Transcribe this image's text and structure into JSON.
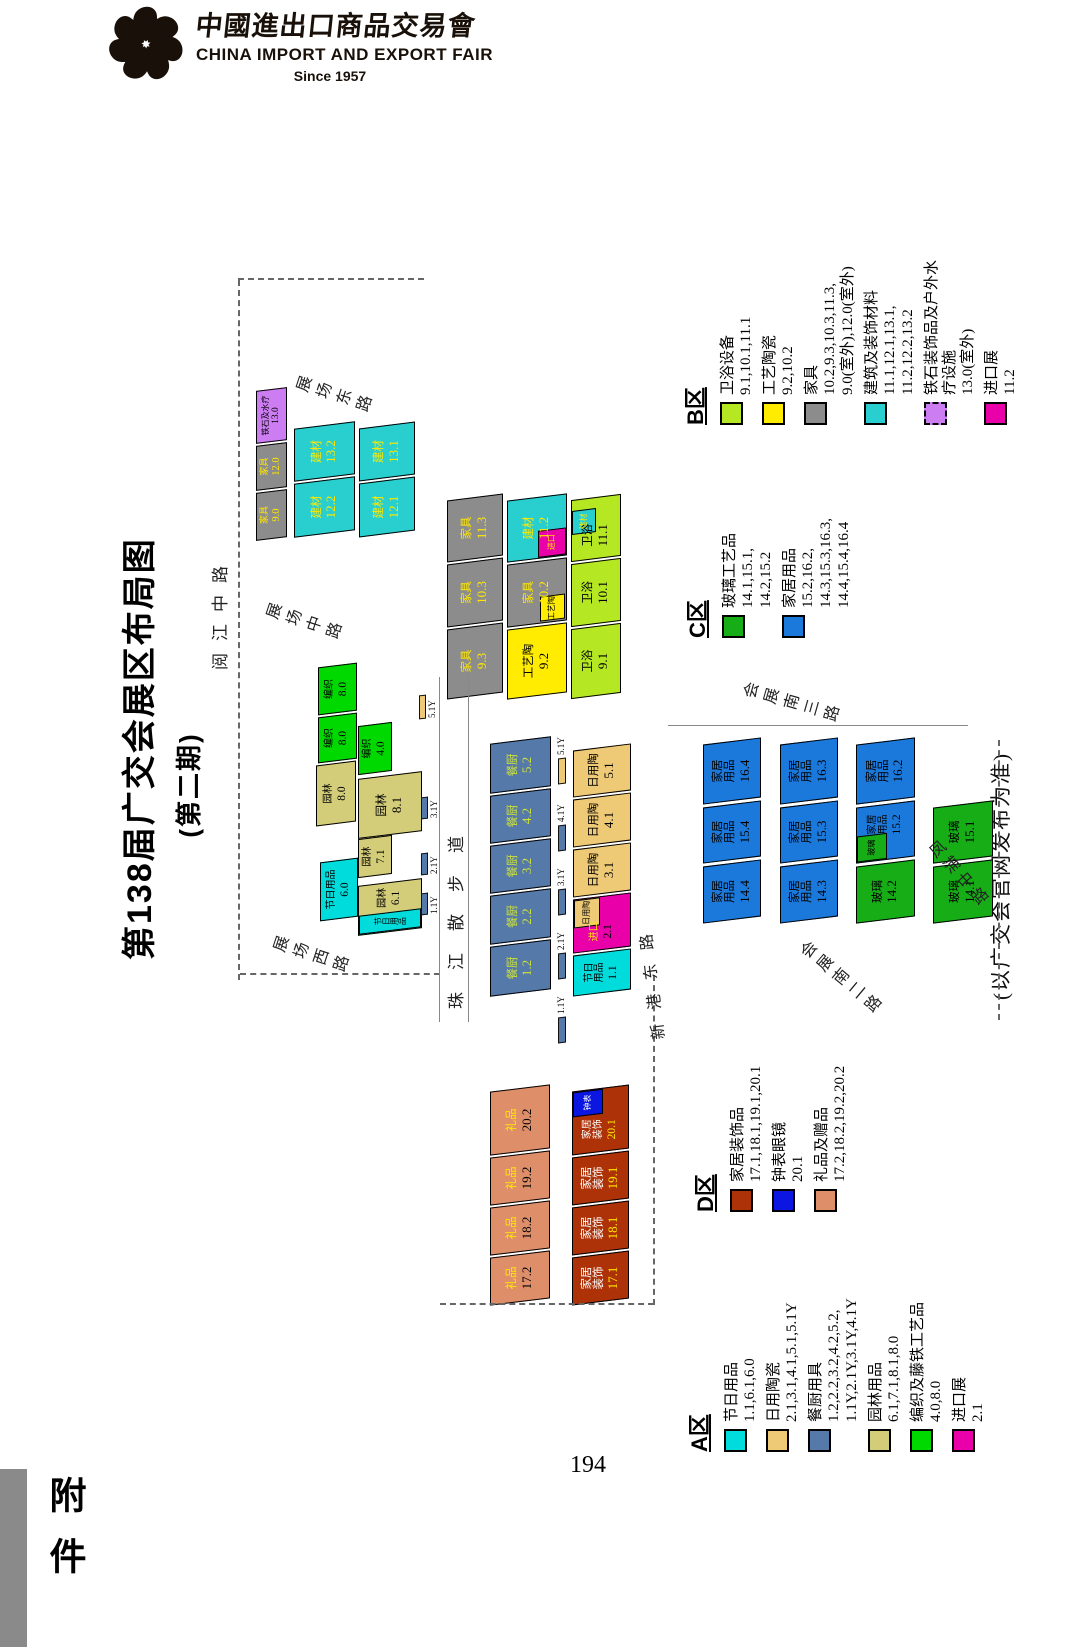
{
  "header": {
    "logo_cn": "中國進出口商品交易會",
    "logo_en": "CHINA IMPORT AND EXPORT FAIR",
    "logo_since": "Since 1957"
  },
  "title": {
    "main": "第138届广交会展区布局图",
    "sub": "(第二期)"
  },
  "note": "(以广交会官网发布为准)",
  "footer": {
    "page_number": "194",
    "attachment": "附件"
  },
  "icons": {
    "logo": "canton-fair-flower-icon"
  },
  "colors": {
    "cyan": "#00dbdb",
    "wheat": "#efca76",
    "steelblue": "#5579a8",
    "khaki": "#d3cc79",
    "agreen": "#00d900",
    "magenta": "#ea00a8",
    "ygreen": "#b5e822",
    "yellow": "#ffec00",
    "gray": "#8c8c8c",
    "teal": "#29cfcf",
    "violet": "#cd7df2",
    "darkred": "#ae3208",
    "salmon": "#df8e6a",
    "cblue": "#1c79dc",
    "cgreen": "#16ad16",
    "dblue": "#0b16e0"
  },
  "legends": [
    {
      "id": "A",
      "title": "A区",
      "x": 8,
      "y": 592,
      "w": 215,
      "entries": [
        {
          "name": "节日用品",
          "nums": [
            "1.1,6.1,6.0"
          ],
          "color": "cyan"
        },
        {
          "name": "日用陶瓷",
          "nums": [
            "2.1,3.1,4.1,5.1,5.1Y"
          ],
          "color": "wheat"
        },
        {
          "name": "餐厨用具",
          "nums": [
            "1.2,2.2,3.2,4.2,5.2,",
            "1.1Y,2.1Y,3.1Y,4.1Y"
          ],
          "color": "steelblue"
        },
        {
          "name": "园林用品",
          "nums": [
            "6.1,7.1,8.1,8.0"
          ],
          "color": "khaki"
        },
        {
          "name": "编织及藤铁工艺品",
          "nums": [
            "4.0,8.0"
          ],
          "color": "agreen"
        },
        {
          "name": "进口展",
          "nums": [
            "2.1"
          ],
          "color": "magenta"
        }
      ]
    },
    {
      "id": "D",
      "title": "D区",
      "x": 248,
      "y": 598,
      "w": 220,
      "entries": [
        {
          "name": "家居装饰品",
          "nums": [
            "17.1,18.1,19.1,20.1"
          ],
          "color": "darkred"
        },
        {
          "name": "钟表眼镜",
          "nums": [
            "20.1"
          ],
          "color": "dblue"
        },
        {
          "name": "礼品及赠品",
          "nums": [
            "17.2,18.2,19.2,20.2"
          ],
          "color": "salmon"
        }
      ]
    },
    {
      "id": "C",
      "title": "C区",
      "x": 822,
      "y": 590,
      "w": 205,
      "entries": [
        {
          "name": "玻璃工艺品",
          "nums": [
            "14.1,15.1,",
            "14.2,15.2"
          ],
          "color": "cgreen"
        },
        {
          "name": "家居用品",
          "nums": [
            "15.2,16.2,",
            "14.3,15.3,16.3,",
            "14.4,15.4,16.4"
          ],
          "color": "cblue"
        }
      ]
    },
    {
      "id": "B",
      "title": "B区",
      "x": 1035,
      "y": 588,
      "w": 175,
      "entries": [
        {
          "name": "卫浴设备",
          "nums": [
            "9.1,10.1,11.1"
          ],
          "color": "ygreen"
        },
        {
          "name": "工艺陶瓷",
          "nums": [
            "9.2,10.2"
          ],
          "color": "yellow"
        },
        {
          "name": "家具",
          "nums": [
            "10.2,9.3,10.3,11.3,",
            "9.0(室外),12.0(室外)"
          ],
          "color": "gray"
        },
        {
          "name": "建筑及装饰材料",
          "nums": [
            "11.1,12.1,13.1,",
            "11.2,12.2,13.2"
          ],
          "color": "teal"
        },
        {
          "name": "铁石装饰品及户外水疗设施",
          "nums": [
            "13.0(室外)"
          ],
          "color": "violet",
          "dashed": true
        },
        {
          "name": "进口展",
          "nums": [
            "11.2"
          ],
          "color": "magenta"
        }
      ]
    }
  ],
  "map": {
    "blocks": [
      {
        "n": "家具",
        "v": "9.0",
        "c": "gray",
        "x": 921,
        "y": 166,
        "w": 48,
        "h": 31,
        "fs": 9
      },
      {
        "n": "家具",
        "v": "12.0",
        "c": "gray",
        "x": 971,
        "y": 166,
        "w": 45,
        "h": 31,
        "fs": 9
      },
      {
        "n": "铁石及水疗",
        "v": "13.0",
        "c": "violet",
        "x": 1018,
        "y": 166,
        "w": 53,
        "h": 31,
        "fs": 8
      },
      {
        "n": "建材",
        "v": "12.2",
        "c": "teal",
        "x": 926,
        "y": 204,
        "w": 54,
        "h": 61
      },
      {
        "n": "建材",
        "v": "13.2",
        "c": "teal",
        "x": 982,
        "y": 204,
        "w": 53,
        "h": 61
      },
      {
        "n": "建材",
        "v": "12.1",
        "c": "teal",
        "x": 926,
        "y": 269,
        "w": 54,
        "h": 56
      },
      {
        "n": "建材",
        "v": "13.1",
        "c": "teal",
        "x": 982,
        "y": 269,
        "w": 53,
        "h": 56
      },
      {
        "n": "家具",
        "v": "9.3",
        "c": "gray",
        "x": 764,
        "y": 357,
        "w": 70,
        "h": 56
      },
      {
        "n": "家具",
        "v": "10.3",
        "c": "gray",
        "x": 836,
        "y": 357,
        "w": 63,
        "h": 56
      },
      {
        "n": "家具",
        "v": "11.3",
        "c": "gray",
        "x": 901,
        "y": 357,
        "w": 62,
        "h": 56
      },
      {
        "n": "工艺陶",
        "v": "9.2",
        "c": "yellow",
        "x": 764,
        "y": 417,
        "w": 70,
        "h": 60
      },
      {
        "n": "家具",
        "v": "10.2",
        "c": "gray",
        "x": 836,
        "y": 417,
        "w": 63,
        "h": 60,
        "patches": [
          {
            "l": "2%",
            "tp": "56%",
            "w": "40%",
            "h": "42%",
            "c": "yellow",
            "lab": "工艺陶",
            "lc": "#000"
          }
        ]
      },
      {
        "n": "建材",
        "v": "11.2",
        "c": "teal",
        "x": 901,
        "y": 417,
        "w": 62,
        "h": 60,
        "patches": [
          {
            "l": "0%",
            "tp": "52%",
            "w": "45%",
            "h": "48%",
            "c": "magenta",
            "lab": "进口",
            "lc": "#ffe800"
          }
        ]
      },
      {
        "n": "卫浴",
        "v": "9.1",
        "c": "ygreen",
        "x": 764,
        "y": 481,
        "w": 70,
        "h": 50
      },
      {
        "n": "卫浴",
        "v": "10.1",
        "c": "ygreen",
        "x": 836,
        "y": 481,
        "w": 63,
        "h": 50
      },
      {
        "n": "卫浴",
        "v": "11.1",
        "c": "ygreen",
        "x": 901,
        "y": 481,
        "w": 62,
        "h": 50,
        "pad": "padding-right:24%",
        "patches": [
          {
            "l": "44%",
            "tp": "0%",
            "w": "40%",
            "h": "50%",
            "c": "teal",
            "lab": "建材",
            "lc": "#ffe800"
          }
        ]
      },
      {
        "n": "节日用品",
        "v": "6.0",
        "c": "cyan",
        "x": 541,
        "y": 230,
        "w": 59,
        "h": 38,
        "fs": 10
      },
      {
        "n": "园林",
        "v": "8.0",
        "c": "khaki",
        "x": 636,
        "y": 226,
        "w": 61,
        "h": 40,
        "fs": 10
      },
      {
        "n": "编织",
        "v": "8.0",
        "c": "agreen",
        "x": 699,
        "y": 228,
        "w": 46,
        "h": 39,
        "fs": 10
      },
      {
        "n": "编织",
        "v": "8.0",
        "c": "agreen",
        "x": 747,
        "y": 228,
        "w": 48,
        "h": 39,
        "fs": 10
      },
      {
        "n": "园林",
        "v": "6.1",
        "c": "khaki",
        "x": 528,
        "y": 268,
        "w": 50,
        "h": 64,
        "fs": 10,
        "pad": "padding-left:38%",
        "patches": [
          {
            "l": "0%",
            "tp": "0%",
            "w": "40%",
            "h": "100%",
            "c": "cyan",
            "lab": "节日用品",
            "lc": "#000",
            "vert": true
          }
        ]
      },
      {
        "n": "园林",
        "v": "7.1",
        "c": "khaki",
        "x": 584,
        "y": 268,
        "w": 39,
        "h": 34,
        "fs": 10
      },
      {
        "n": "园林",
        "v": "8.1",
        "c": "khaki",
        "x": 625,
        "y": 268,
        "w": 60,
        "h": 64
      },
      {
        "n": "编织",
        "v": "4.0",
        "c": "agreen",
        "x": 687,
        "y": 268,
        "w": 49,
        "h": 34,
        "fs": 10
      },
      {
        "n": "餐厨",
        "v": "1.2",
        "c": "steelblue",
        "x": 467,
        "y": 400,
        "w": 50,
        "h": 61
      },
      {
        "n": "餐厨",
        "v": "2.2",
        "c": "steelblue",
        "x": 519,
        "y": 400,
        "w": 49,
        "h": 61
      },
      {
        "n": "餐厨",
        "v": "3.2",
        "c": "steelblue",
        "x": 570,
        "y": 400,
        "w": 48,
        "h": 61
      },
      {
        "n": "餐厨",
        "v": "4.2",
        "c": "steelblue",
        "x": 620,
        "y": 400,
        "w": 48,
        "h": 61
      },
      {
        "n": "餐厨",
        "v": "5.2",
        "c": "steelblue",
        "x": 670,
        "y": 400,
        "w": 50,
        "h": 61
      },
      {
        "n": "节日|用品",
        "v": "1.1",
        "c": "cyan",
        "x": 467,
        "y": 483,
        "w": 41,
        "h": 58,
        "fs": 10
      },
      {
        "n": "进口",
        "v": "2.1",
        "c": "magenta",
        "x": 510,
        "y": 483,
        "w": 54,
        "h": 58,
        "fs": 10,
        "pad": "padding-right:32%",
        "patches": [
          {
            "l": "46%",
            "tp": "0%",
            "w": "54%",
            "h": "46%",
            "c": "wheat",
            "lab": "日用陶",
            "lc": "#000"
          }
        ]
      },
      {
        "n": "日用陶",
        "v": "3.1",
        "c": "wheat",
        "x": 566,
        "y": 483,
        "w": 48,
        "h": 58
      },
      {
        "n": "日用陶",
        "v": "4.1",
        "c": "wheat",
        "x": 616,
        "y": 483,
        "w": 48,
        "h": 58
      },
      {
        "n": "日用陶",
        "v": "5.1",
        "c": "wheat",
        "x": 666,
        "y": 483,
        "w": 47,
        "h": 58
      },
      {
        "n": "家居|用品",
        "v": "14.4",
        "c": "cblue",
        "x": 540,
        "y": 613,
        "w": 57,
        "h": 58
      },
      {
        "n": "家居|用品",
        "v": "15.4",
        "c": "cblue",
        "x": 600,
        "y": 613,
        "w": 56,
        "h": 58
      },
      {
        "n": "家居|用品",
        "v": "16.4",
        "c": "cblue",
        "x": 659,
        "y": 613,
        "w": 60,
        "h": 58
      },
      {
        "n": "家居|用品",
        "v": "14.3",
        "c": "cblue",
        "x": 540,
        "y": 690,
        "w": 57,
        "h": 58
      },
      {
        "n": "家居|用品",
        "v": "15.3",
        "c": "cblue",
        "x": 600,
        "y": 690,
        "w": 56,
        "h": 58
      },
      {
        "n": "家居|用品",
        "v": "16.3",
        "c": "cblue",
        "x": 659,
        "y": 690,
        "w": 60,
        "h": 58
      },
      {
        "n": "玻璃",
        "v": "14.2",
        "c": "cgreen",
        "x": 540,
        "y": 766,
        "w": 57,
        "h": 59
      },
      {
        "n": "家居|用品",
        "v": "15.2",
        "c": "cblue",
        "x": 600,
        "y": 766,
        "w": 56,
        "h": 59,
        "fs": 10,
        "pad": "padding-left:28%",
        "patches": [
          {
            "l": "0%",
            "tp": "0%",
            "w": "48%",
            "h": "52%",
            "c": "cgreen",
            "lab": "玻璃",
            "lc": "#000"
          }
        ]
      },
      {
        "n": "家居|用品",
        "v": "16.2",
        "c": "cblue",
        "x": 659,
        "y": 766,
        "w": 60,
        "h": 59
      },
      {
        "n": "玻璃",
        "v": "14.1",
        "c": "cgreen",
        "x": 540,
        "y": 843,
        "w": 57,
        "h": 60
      },
      {
        "n": "玻璃",
        "v": "15.1",
        "c": "cgreen",
        "x": 600,
        "y": 843,
        "w": 56,
        "h": 60
      },
      {
        "n": "礼品",
        "v": "17.2",
        "c": "salmon",
        "x": 158,
        "y": 400,
        "w": 48,
        "h": 60
      },
      {
        "n": "礼品",
        "v": "18.2",
        "c": "salmon",
        "x": 208,
        "y": 400,
        "w": 48,
        "h": 60
      },
      {
        "n": "礼品",
        "v": "19.2",
        "c": "salmon",
        "x": 258,
        "y": 400,
        "w": 48,
        "h": 60
      },
      {
        "n": "礼品",
        "v": "20.2",
        "c": "salmon",
        "x": 308,
        "y": 400,
        "w": 64,
        "h": 60
      },
      {
        "n": "家居|装饰",
        "v": "17.1",
        "c": "darkred",
        "x": 158,
        "y": 482,
        "w": 48,
        "h": 57
      },
      {
        "n": "家居|装饰",
        "v": "18.1",
        "c": "darkred",
        "x": 208,
        "y": 482,
        "w": 48,
        "h": 57
      },
      {
        "n": "家居|装饰",
        "v": "19.1",
        "c": "darkred",
        "x": 258,
        "y": 482,
        "w": 48,
        "h": 57
      },
      {
        "n": "家居|装饰",
        "v": "20.1",
        "c": "darkred",
        "x": 308,
        "y": 482,
        "w": 64,
        "h": 57,
        "fs": 10,
        "pad": "padding-right:30%",
        "patches": [
          {
            "l": "60%",
            "tp": "0%",
            "w": "40%",
            "h": "55%",
            "c": "dblue",
            "lab": "钟表",
            "lc": "#fff"
          }
        ]
      }
    ],
    "annexes": [
      {
        "lab": "1.1Y",
        "x": 545,
        "y": 331,
        "w": 22,
        "h": 7,
        "c": "steelblue",
        "pos": "b"
      },
      {
        "lab": "2.1Y",
        "x": 585,
        "y": 331,
        "w": 22,
        "h": 7,
        "c": "steelblue",
        "pos": "b"
      },
      {
        "lab": "3.1Y",
        "x": 641,
        "y": 331,
        "w": 22,
        "h": 7,
        "c": "steelblue",
        "pos": "b"
      },
      {
        "lab": "5.1Y",
        "x": 741,
        "y": 329,
        "w": 24,
        "h": 7,
        "c": "wheat",
        "pos": "b"
      },
      {
        "lab": "1.1Y",
        "x": 417,
        "y": 468,
        "w": 26,
        "h": 8,
        "c": "steelblue",
        "pos": "r"
      },
      {
        "lab": "2.1Y",
        "x": 481,
        "y": 468,
        "w": 26,
        "h": 8,
        "c": "steelblue",
        "pos": "r"
      },
      {
        "lab": "3.1Y",
        "x": 545,
        "y": 468,
        "w": 26,
        "h": 8,
        "c": "steelblue",
        "pos": "r"
      },
      {
        "lab": "4.1Y",
        "x": 609,
        "y": 468,
        "w": 26,
        "h": 8,
        "c": "steelblue",
        "pos": "r"
      },
      {
        "lab": "5.1Y",
        "x": 676,
        "y": 468,
        "w": 26,
        "h": 8,
        "c": "wheat",
        "pos": "r"
      }
    ],
    "roads": [
      {
        "t": "阅江中路",
        "x": 790,
        "y": 116,
        "mode": "h",
        "ls": 12,
        "fs": 17
      },
      {
        "t": "展场东路",
        "x": 1051,
        "y": 203,
        "mode": "v",
        "rot": 18,
        "fs": 16
      },
      {
        "t": "展场中路",
        "x": 824,
        "y": 173,
        "mode": "v",
        "rot": 18,
        "fs": 16
      },
      {
        "t": "展场西路",
        "x": 491,
        "y": 180,
        "mode": "v",
        "rot": 18,
        "fs": 16
      },
      {
        "t": "珠江散步道",
        "x": 451,
        "y": 352,
        "mode": "h",
        "ls": 22,
        "fs": 17
      },
      {
        "t": "新港东路",
        "x": 420,
        "y": 548,
        "mode": "h",
        "ls": 14,
        "fs": 16,
        "rot": -7
      },
      {
        "t": "会展南三路",
        "x": 743,
        "y": 650,
        "mode": "v",
        "rot": 16,
        "fs": 16
      },
      {
        "t": "会展南二路",
        "x": 468,
        "y": 698,
        "mode": "v",
        "rot": 40,
        "fs": 16
      },
      {
        "t": "凤浦中路",
        "x": 572,
        "y": 826,
        "mode": "v",
        "rot": 48,
        "fs": 16
      }
    ],
    "guides": {
      "dashes": [
        {
          "o": "h",
          "x": 480,
          "y": 148,
          "len": 700
        },
        {
          "o": "v",
          "x": 1180,
          "y": 148,
          "len": 186
        },
        {
          "o": "v",
          "x": 485,
          "y": 150,
          "len": 200
        },
        {
          "o": "h",
          "x": 155,
          "y": 563,
          "len": 330
        },
        {
          "o": "v",
          "x": 155,
          "y": 350,
          "len": 214
        },
        {
          "o": "h",
          "x": 440,
          "y": 908,
          "len": 280
        }
      ],
      "lines": [
        {
          "o": "h",
          "x": 438,
          "y": 349,
          "len": 345
        },
        {
          "o": "h",
          "x": 438,
          "y": 378,
          "len": 345
        },
        {
          "o": "v",
          "x": 734,
          "y": 578,
          "len": 300
        }
      ]
    }
  }
}
